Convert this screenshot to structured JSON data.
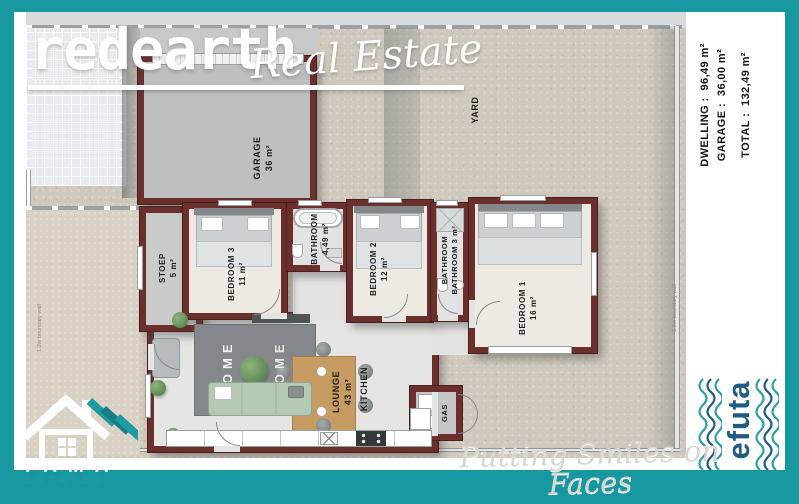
{
  "header": {
    "brand_main": "redearth",
    "brand_sub": "Real Estate"
  },
  "stats": {
    "lines": [
      {
        "label": "DWELLING :",
        "value": "96,49 m²"
      },
      {
        "label": "GARAGE :",
        "value": "36,00 m²"
      },
      {
        "label": "TOTAL :",
        "value": "132,49 m²"
      }
    ]
  },
  "rooms": {
    "garage": {
      "label": "GARAGE",
      "area": "36 m²"
    },
    "yard": {
      "label": "YARD"
    },
    "stoep": {
      "label": "STOEP",
      "area": "5 m²"
    },
    "bedroom3": {
      "label": "BEDROOM 3",
      "area": "11 m²"
    },
    "bathroom": {
      "label": "BATHROOM",
      "area": "4,49 m²"
    },
    "bedroom2": {
      "label": "BEDROOM 2",
      "area": "12 m²"
    },
    "bathroom2": {
      "label": "BATHROOM",
      "label2": "BATHROOM",
      "area": "3 m²"
    },
    "bedroom1": {
      "label": "BEDROOM 1",
      "area": "16 m²"
    },
    "lounge": {
      "label": "LOUNGE",
      "area": "43 m²"
    },
    "kitchen": {
      "label": "KITCHEN"
    },
    "gas": {
      "label": "GAS"
    }
  },
  "annotations": {
    "boundary_wall": "1.2m boundary wall"
  },
  "decor": {
    "rug_text": "HOME"
  },
  "tama": {
    "line1": "TAMA",
    "line2": "ESTATES"
  },
  "efuta": {
    "name": "efuta"
  },
  "footer": {
    "tagline": "Putting Smiles on Faces"
  },
  "colors": {
    "teal": "#1798a0",
    "wall": "#6b2f2c",
    "efuta_blue": "#1e5c85"
  }
}
